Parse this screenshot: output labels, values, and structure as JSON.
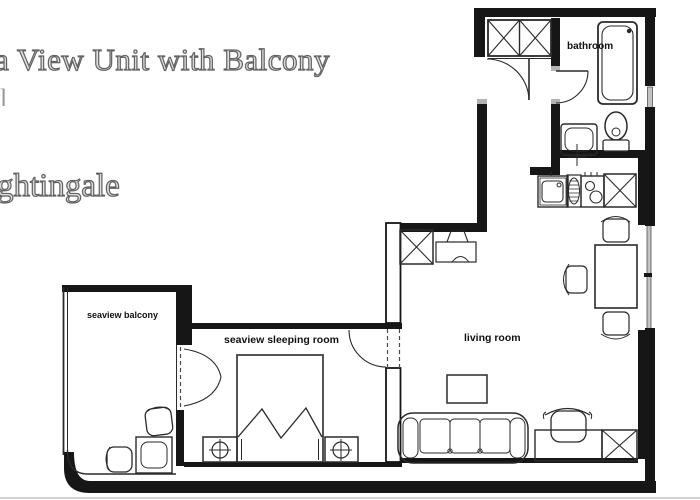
{
  "page": {
    "title_fragment": "a View Unit with Balcony",
    "cutoff_fragment": "l",
    "subtitle_fragment": "ghtingale"
  },
  "floorplan": {
    "rooms": {
      "bathroom": "bathroom",
      "balcony": "seaview balcony",
      "bedroom": "seaview sleeping room",
      "living": "living room"
    },
    "colors": {
      "wall": "#161616",
      "line": "#2a2a2a",
      "glass": "#c2c2c2",
      "shade": "#b3b3b3",
      "background": "#ffffff",
      "title_fill": "#dedede",
      "title_stroke": "#636363"
    }
  }
}
